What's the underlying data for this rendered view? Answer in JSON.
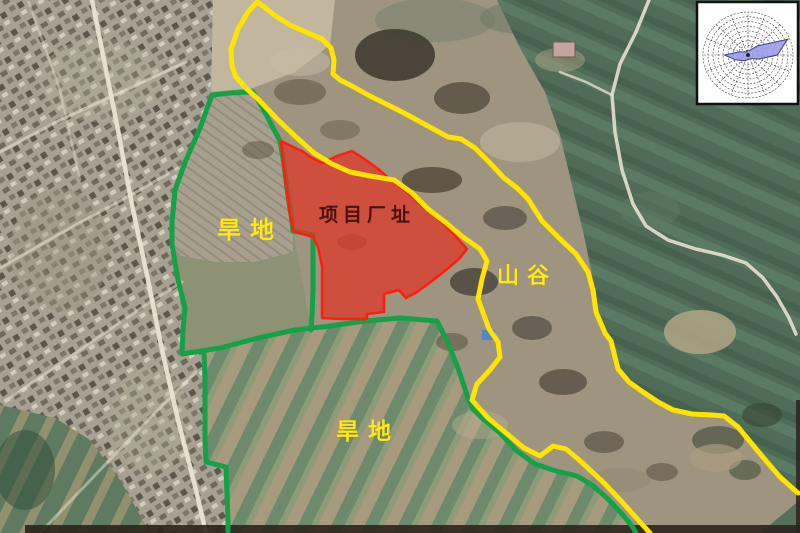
{
  "map": {
    "description": "satellite-annotation-map",
    "labels": [
      {
        "id": "project-site",
        "text": "项目厂址",
        "x": 319,
        "y": 206,
        "size": 19,
        "spacing": 5,
        "color": "#4a1210",
        "cls": "site"
      },
      {
        "id": "dryland-upper",
        "text": "旱地",
        "x": 217,
        "y": 219,
        "size": 24,
        "spacing": 9,
        "color": "#ffe816",
        "cls": "land"
      },
      {
        "id": "dryland-lower",
        "text": "旱地",
        "x": 336,
        "y": 420,
        "size": 23,
        "spacing": 9,
        "color": "#ffe816",
        "cls": "land"
      },
      {
        "id": "valley",
        "text": "山谷",
        "x": 497,
        "y": 265,
        "size": 22,
        "spacing": 8,
        "color": "#ffe816",
        "cls": "land"
      }
    ],
    "boundaries": {
      "yellow_valley_line": {
        "color": "#ffe400",
        "width": 5,
        "points": [
          [
            650,
            533
          ],
          [
            640,
            522
          ],
          [
            622,
            502
          ],
          [
            604,
            483
          ],
          [
            590,
            470
          ],
          [
            578,
            459
          ],
          [
            566,
            449
          ],
          [
            553,
            446
          ],
          [
            540,
            456
          ],
          [
            524,
            448
          ],
          [
            506,
            433
          ],
          [
            488,
            418
          ],
          [
            472,
            400
          ],
          [
            477,
            384
          ],
          [
            490,
            370
          ],
          [
            500,
            357
          ],
          [
            498,
            342
          ],
          [
            489,
            329
          ],
          [
            478,
            299
          ],
          [
            482,
            279
          ],
          [
            487,
            261
          ],
          [
            480,
            249
          ],
          [
            463,
            237
          ],
          [
            445,
            222
          ],
          [
            428,
            209
          ],
          [
            412,
            193
          ],
          [
            394,
            180
          ],
          [
            370,
            176
          ],
          [
            350,
            172
          ],
          [
            332,
            164
          ],
          [
            314,
            153
          ],
          [
            296,
            137
          ],
          [
            277,
            119
          ],
          [
            260,
            101
          ],
          [
            247,
            89
          ],
          [
            236,
            77
          ],
          [
            232,
            66
          ],
          [
            231,
            49
          ],
          [
            238,
            29
          ],
          [
            248,
            12
          ],
          [
            257,
            2
          ],
          [
            263,
            6
          ],
          [
            274,
            15
          ],
          [
            290,
            25
          ],
          [
            308,
            33
          ],
          [
            322,
            39
          ],
          [
            331,
            48
          ],
          [
            334,
            60
          ],
          [
            333,
            74
          ],
          [
            340,
            80
          ],
          [
            352,
            86
          ],
          [
            368,
            95
          ],
          [
            386,
            104
          ],
          [
            404,
            113
          ],
          [
            426,
            125
          ],
          [
            448,
            137
          ],
          [
            461,
            139
          ],
          [
            475,
            148
          ],
          [
            490,
            163
          ],
          [
            504,
            178
          ],
          [
            517,
            188
          ],
          [
            528,
            199
          ],
          [
            542,
            221
          ],
          [
            560,
            239
          ],
          [
            576,
            254
          ],
          [
            588,
            272
          ],
          [
            593,
            290
          ],
          [
            596,
            312
          ],
          [
            605,
            333
          ],
          [
            611,
            341
          ],
          [
            618,
            369
          ],
          [
            629,
            382
          ],
          [
            643,
            392
          ],
          [
            658,
            402
          ],
          [
            673,
            410
          ],
          [
            692,
            414
          ],
          [
            712,
            415
          ],
          [
            724,
            416
          ],
          [
            738,
            427
          ],
          [
            752,
            444
          ],
          [
            767,
            462
          ],
          [
            780,
            477
          ],
          [
            790,
            486
          ],
          [
            798,
            493
          ]
        ]
      },
      "green_outer_boundary": {
        "color": "#14a148",
        "width": 5,
        "points": [
          [
            212,
            95
          ],
          [
            200,
            128
          ],
          [
            186,
            160
          ],
          [
            175,
            190
          ],
          [
            172,
            222
          ],
          [
            172,
            245
          ],
          [
            178,
            280
          ],
          [
            185,
            308
          ],
          [
            183,
            330
          ],
          [
            182,
            354
          ],
          [
            220,
            348
          ],
          [
            258,
            338
          ],
          [
            295,
            330
          ],
          [
            330,
            326
          ],
          [
            365,
            321
          ],
          [
            400,
            318
          ],
          [
            437,
            321
          ],
          [
            447,
            341
          ],
          [
            458,
            368
          ],
          [
            468,
            398
          ],
          [
            472,
            408
          ],
          [
            483,
            419
          ],
          [
            500,
            433
          ],
          [
            517,
            451
          ],
          [
            535,
            464
          ],
          [
            556,
            471
          ],
          [
            577,
            476
          ],
          [
            592,
            485
          ],
          [
            607,
            498
          ],
          [
            622,
            514
          ],
          [
            632,
            526
          ],
          [
            636,
            533
          ]
        ]
      },
      "green_east_boundary": {
        "color": "#14a148",
        "width": 5,
        "points": [
          [
            212,
            95
          ],
          [
            230,
            93
          ],
          [
            253,
            92
          ],
          [
            262,
            107
          ],
          [
            271,
            124
          ],
          [
            280,
            141
          ],
          [
            284,
            165
          ],
          [
            287,
            189
          ],
          [
            291,
            215
          ],
          [
            293,
            231
          ],
          [
            313,
            235
          ],
          [
            313,
            262
          ],
          [
            313,
            290
          ],
          [
            312,
            315
          ],
          [
            311,
            330
          ]
        ]
      },
      "green_inner_boundary": {
        "color": "#14a148",
        "width": 5,
        "points": [
          [
            204,
            353
          ],
          [
            205,
            380
          ],
          [
            205,
            410
          ],
          [
            205,
            440
          ],
          [
            206,
            462
          ],
          [
            226,
            467
          ],
          [
            227,
            495
          ],
          [
            228,
            520
          ],
          [
            228,
            531
          ]
        ]
      },
      "red_site_polygon": {
        "fill": "#e23222",
        "fill_opacity": 0.7,
        "stroke": "#ff1d0e",
        "stroke_width": 2.5,
        "points": [
          [
            281,
            141
          ],
          [
            291,
            146
          ],
          [
            302,
            151
          ],
          [
            312,
            158
          ],
          [
            322,
            163
          ],
          [
            337,
            156
          ],
          [
            352,
            151
          ],
          [
            363,
            158
          ],
          [
            377,
            168
          ],
          [
            392,
            181
          ],
          [
            408,
            193
          ],
          [
            424,
            207
          ],
          [
            440,
            221
          ],
          [
            455,
            236
          ],
          [
            467,
            249
          ],
          [
            459,
            259
          ],
          [
            446,
            270
          ],
          [
            432,
            281
          ],
          [
            417,
            292
          ],
          [
            406,
            298
          ],
          [
            399,
            290
          ],
          [
            384,
            294
          ],
          [
            384,
            312
          ],
          [
            367,
            314
          ],
          [
            367,
            319
          ],
          [
            341,
            319
          ],
          [
            322,
            318
          ],
          [
            322,
            292
          ],
          [
            322,
            266
          ],
          [
            318,
            247
          ],
          [
            313,
            237
          ],
          [
            303,
            234
          ],
          [
            293,
            231
          ],
          [
            289,
            209
          ],
          [
            286,
            186
          ],
          [
            283,
            163
          ]
        ]
      }
    },
    "wind_rose": {
      "box": {
        "x": 697,
        "y": 2,
        "width": 101,
        "height": 102,
        "bg": "#ffffff",
        "border": "#111111"
      },
      "center": {
        "x": 748,
        "y": 55
      },
      "radius_x": 45,
      "radius_y": 43,
      "rings": 9,
      "spokes": 16,
      "grid_color": "#444444",
      "petal_fill": "#9c9cea",
      "petal_stroke": "#3c3c96",
      "petal_radii": [
        0.1,
        0.12,
        0.3,
        0.95,
        0.65,
        0.25,
        0.12,
        0.1,
        0.1,
        0.14,
        0.18,
        0.3,
        0.52,
        0.2,
        0.1,
        0.08
      ]
    }
  }
}
